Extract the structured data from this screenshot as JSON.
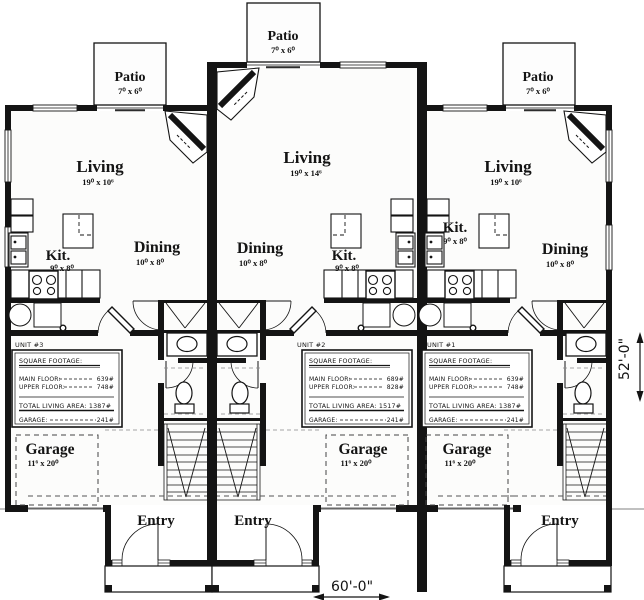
{
  "plan": {
    "dims": {
      "width": "60'-0\"",
      "depth": "52'-0\""
    },
    "units": [
      {
        "name": "UNIT #3",
        "patio_label": "Patio",
        "patio_dims": "7⁰ x 6⁰",
        "living_label": "Living",
        "living_dims": "19⁰ x 10⁶",
        "dining_label": "Dining",
        "dining_dims": "10⁰ x 8⁰",
        "kitchen_label": "Kit.",
        "kitchen_dims": "9⁰ x 8⁰",
        "garage_label": "Garage",
        "garage_dims": "11⁶ x 20⁰",
        "entry_label": "Entry",
        "sqft": {
          "heading": "SQUARE FOOTAGE:",
          "main_label": "MAIN FLOOR:",
          "main_value": "639#",
          "upper_label": "UPPER FLOOR:",
          "upper_value": "748#",
          "total": "TOTAL LIVING AREA: 1387#",
          "garage_label": "GARAGE:",
          "garage_value": "241#"
        }
      },
      {
        "name": "UNIT #2",
        "patio_label": "Patio",
        "patio_dims": "7⁰ x 6⁰",
        "living_label": "Living",
        "living_dims": "19⁰ x 14⁶",
        "dining_label": "Dining",
        "dining_dims": "10⁰ x 8⁰",
        "kitchen_label": "Kit.",
        "kitchen_dims": "9⁰ x 8⁰",
        "garage_label": "Garage",
        "garage_dims": "11⁶ x 20⁰",
        "entry_label": "Entry",
        "sqft": {
          "heading": "SQUARE FOOTAGE:",
          "main_label": "MAIN FLOOR:",
          "main_value": "689#",
          "upper_label": "UPPER FLOOR:",
          "upper_value": "828#",
          "total": "TOTAL LIVING AREA: 1517#",
          "garage_label": "GARAGE:",
          "garage_value": "241#"
        }
      },
      {
        "name": "UNIT #1",
        "patio_label": "Patio",
        "patio_dims": "7⁰ x 6⁰",
        "living_label": "Living",
        "living_dims": "19⁰ x 10⁶",
        "dining_label": "Dining",
        "dining_dims": "10⁰ x 8⁰",
        "kitchen_label": "Kit.",
        "kitchen_dims": "9⁰ x 8⁰",
        "garage_label": "Garage",
        "garage_dims": "11⁶ x 20⁰",
        "entry_label": "Entry",
        "sqft": {
          "heading": "SQUARE FOOTAGE:",
          "main_label": "MAIN FLOOR:",
          "main_value": "639#",
          "upper_label": "UPPER FLOOR:",
          "upper_value": "748#",
          "total": "TOTAL LIVING AREA: 1387#",
          "garage_label": "GARAGE:",
          "garage_value": "241#"
        }
      }
    ]
  }
}
